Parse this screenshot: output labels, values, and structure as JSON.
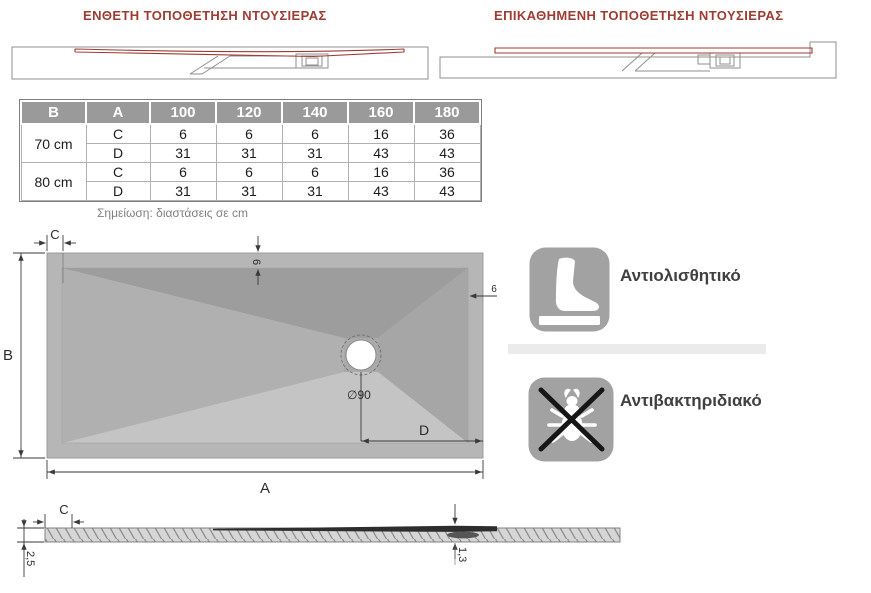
{
  "titles": {
    "inset": "ΕΝΘΕΤΗ ΤΟΠΟΘΕΤΗΣΗ ΝΤΟΥΣΙΕΡΑΣ",
    "on_top": "ΕΠΙΚΑΘΗΜΕΝΗ ΤΟΠΟΘΕΤΗΣΗ ΝΤΟΥΣΙΕΡΑΣ"
  },
  "table": {
    "headers": [
      "B",
      "A",
      "100",
      "120",
      "140",
      "160",
      "180"
    ],
    "groups": [
      {
        "size": "70 cm",
        "rows": [
          {
            "label": "C",
            "values": [
              "6",
              "6",
              "6",
              "16",
              "36"
            ]
          },
          {
            "label": "D",
            "values": [
              "31",
              "31",
              "31",
              "43",
              "43"
            ]
          }
        ]
      },
      {
        "size": "80 cm",
        "rows": [
          {
            "label": "C",
            "values": [
              "6",
              "6",
              "6",
              "16",
              "36"
            ]
          },
          {
            "label": "D",
            "values": [
              "31",
              "31",
              "31",
              "43",
              "43"
            ]
          }
        ]
      }
    ],
    "note": "Σημείωση: διαστάσεις σε cm"
  },
  "top_view": {
    "dim_c": "C",
    "dim_b": "B",
    "dim_a": "A",
    "dim_d": "D",
    "dim_rim_top": "6",
    "dim_rim_right": "6",
    "drain_label": "∅90"
  },
  "features": [
    {
      "label": "Αντιολισθητικό"
    },
    {
      "label": "Αντιβακτηριδιακό"
    }
  ],
  "section": {
    "dim_c": "C",
    "dim_thickness": "2,5",
    "dim_drain": "1,3"
  },
  "colors": {
    "accent_red": "#9e3b32",
    "header_gray": "#9a9a9a",
    "peach": "#f8cbb0",
    "icon_gray": "#a2a2a2",
    "tray_rim": "#b6b6b6",
    "facet_top": "#9d9d9d",
    "facet_right": "#a6a6a6",
    "facet_left": "#b0b0b0",
    "facet_bottom": "#c4c4c4"
  }
}
